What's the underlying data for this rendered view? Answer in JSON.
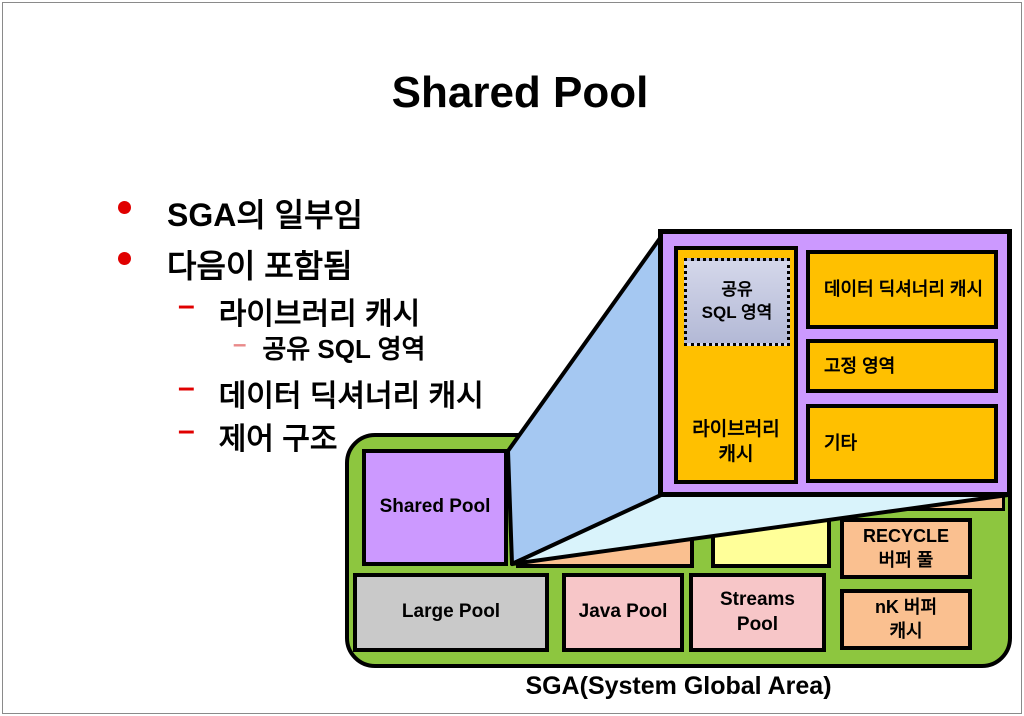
{
  "colors": {
    "green": "#8DC63F",
    "purple": "#CC99FF",
    "amber": "#FFC000",
    "peach": "#FAC090",
    "pink": "#F7C6C8",
    "yellow": "#FFFF99",
    "gray": "#C9C9C9",
    "blue-medium": "#A5C8F2",
    "blue-pale": "#D9F3FB",
    "lavender-top": "#D4D7EA",
    "lavender-bottom": "#B3B9D6",
    "bullet-red": "#E00000",
    "sub-bullet-red": "#E98A8A"
  },
  "title": "Shared Pool",
  "bullets": {
    "items": [
      {
        "label": "SGA의 일부임"
      },
      {
        "label": "다음이 포함됨"
      },
      {
        "label": "라이브러리 캐시"
      },
      {
        "label": "공유 SQL 영역"
      },
      {
        "label": "데이터 딕셔너리 캐시"
      },
      {
        "label": "제어 구조"
      }
    ]
  },
  "detail": {
    "shared_sql_line1": "공유",
    "shared_sql_line2": "SQL 영역",
    "library_cache_line1": "라이브러리",
    "library_cache_line2": "캐시",
    "data_dictionary_cache": "데이터 딕셔너리 캐시",
    "fixed_area": "고정 영역",
    "other": "기타"
  },
  "sga": {
    "shared_pool": "Shared Pool",
    "large_pool": "Large Pool",
    "java_pool": "Java Pool",
    "streams_line1": "Streams",
    "streams_line2": "Pool",
    "recycle_line1": "RECYCLE",
    "recycle_line2": "버퍼 풀",
    "nk_line1": "nK 버퍼",
    "nk_line2": "캐시",
    "caption": "SGA(System Global Area)"
  }
}
